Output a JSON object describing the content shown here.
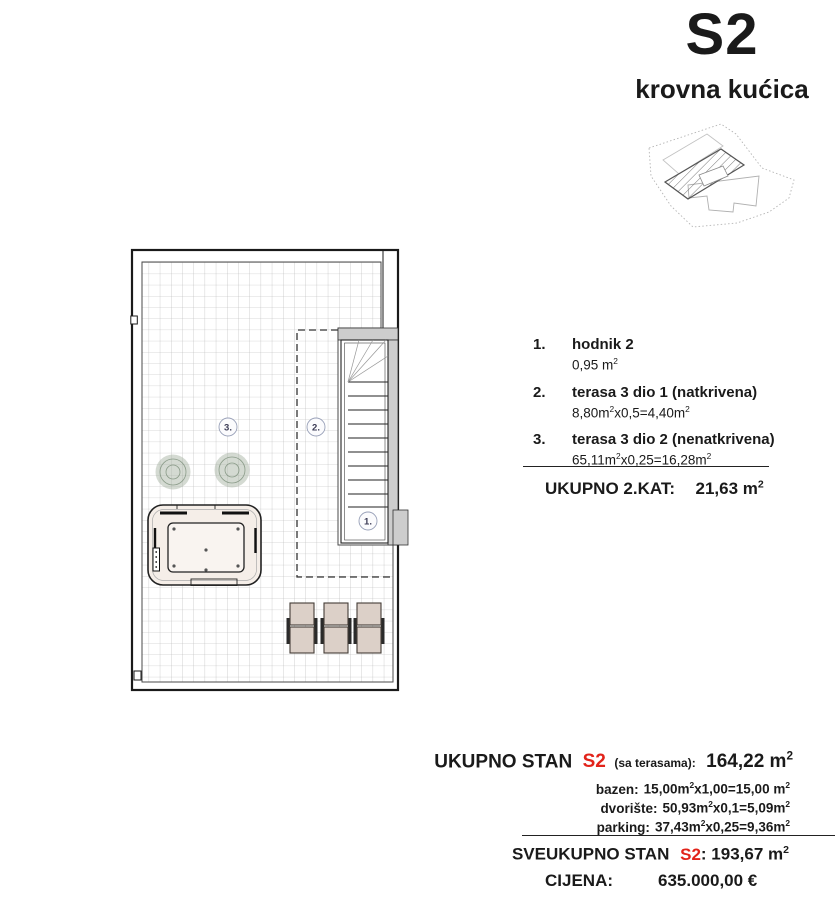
{
  "header": {
    "code": "S2",
    "subtitle": "krovna kućica"
  },
  "colors": {
    "accent_red": "#e2231a",
    "wall_gray": "#cdcdcd"
  },
  "plan": {
    "labels": {
      "area3": "3.",
      "area2": "2.",
      "area1": "1."
    }
  },
  "legend": {
    "items": [
      {
        "num": "1.",
        "name": "hodnik 2",
        "p1": "0,95 m",
        "s1": "2",
        "p2": "",
        "s2": ""
      },
      {
        "num": "2.",
        "name": "terasa 3 dio 1 (natkrivena)",
        "p1": "8,80m",
        "s1": "2",
        "p2": "x0,5=4,40m",
        "s2": "2"
      },
      {
        "num": "3.",
        "name": "terasa 3 dio 2 (nenatkrivena)",
        "p1": "65,11m",
        "s1": "2",
        "p2": "x0,25=16,28m",
        "s2": "2"
      }
    ]
  },
  "kat_total": {
    "label": "UKUPNO 2.KAT:",
    "value": "21,63 m",
    "sup": "2"
  },
  "totals": {
    "stan": {
      "label": "UKUPNO STAN",
      "code": "S2",
      "note": "(sa terasama):",
      "value": "164,22 m",
      "sup": "2"
    },
    "breakdown": [
      {
        "label": "bazen:",
        "p1": "15,00m",
        "s1": "2",
        "p2": "x1,00=15,00 m",
        "s2": "2"
      },
      {
        "label": "dvorište:",
        "p1": "50,93m",
        "s1": "2",
        "p2": "x0,1=5,09m",
        "s2": "2"
      },
      {
        "label": "parking:",
        "p1": "37,43m",
        "s1": "2",
        "p2": "x0,25=9,36m",
        "s2": "2"
      }
    ],
    "sveukupno": {
      "label": "SVEUKUPNO STAN",
      "code": "S2",
      "rest": ": 193,67 m",
      "sup": "2"
    },
    "cijena": {
      "label": "CIJENA:",
      "value": "635.000,00 €"
    }
  }
}
